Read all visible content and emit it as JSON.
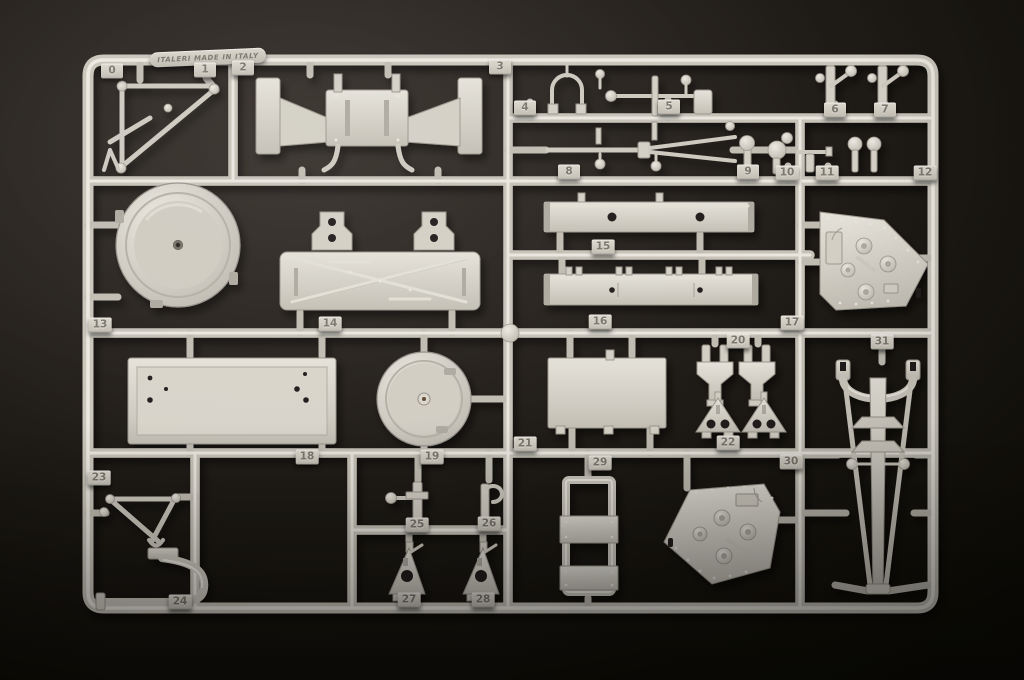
{
  "brand_plaque": {
    "text": "ITALERI MADE IN ITALY"
  },
  "colors": {
    "plastic": "#d5d1c7",
    "plastic_highlight": "#eae7df",
    "plastic_shadow": "#9c978d",
    "background": "#16120f",
    "tab_text": "#7b766c"
  },
  "sprue": {
    "part_count": 32,
    "parts": [
      {
        "label": "0",
        "x": 112,
        "y": 71
      },
      {
        "label": "1",
        "x": 205,
        "y": 70
      },
      {
        "label": "2",
        "x": 243,
        "y": 68
      },
      {
        "label": "3",
        "x": 500,
        "y": 67
      },
      {
        "label": "4",
        "x": 525,
        "y": 108
      },
      {
        "label": "5",
        "x": 669,
        "y": 107
      },
      {
        "label": "6",
        "x": 835,
        "y": 110
      },
      {
        "label": "7",
        "x": 885,
        "y": 110
      },
      {
        "label": "8",
        "x": 569,
        "y": 172
      },
      {
        "label": "9",
        "x": 748,
        "y": 172
      },
      {
        "label": "10",
        "x": 787,
        "y": 173
      },
      {
        "label": "11",
        "x": 827,
        "y": 173
      },
      {
        "label": "12",
        "x": 925,
        "y": 173
      },
      {
        "label": "13",
        "x": 100,
        "y": 325
      },
      {
        "label": "14",
        "x": 330,
        "y": 324
      },
      {
        "label": "15",
        "x": 603,
        "y": 247
      },
      {
        "label": "16",
        "x": 600,
        "y": 322
      },
      {
        "label": "17",
        "x": 792,
        "y": 323
      },
      {
        "label": "18",
        "x": 307,
        "y": 457
      },
      {
        "label": "19",
        "x": 432,
        "y": 457
      },
      {
        "label": "20",
        "x": 738,
        "y": 341
      },
      {
        "label": "21",
        "x": 525,
        "y": 444
      },
      {
        "label": "22",
        "x": 728,
        "y": 443
      },
      {
        "label": "23",
        "x": 99,
        "y": 478
      },
      {
        "label": "24",
        "x": 180,
        "y": 602
      },
      {
        "label": "25",
        "x": 417,
        "y": 525
      },
      {
        "label": "26",
        "x": 489,
        "y": 524
      },
      {
        "label": "27",
        "x": 409,
        "y": 600
      },
      {
        "label": "28",
        "x": 483,
        "y": 600
      },
      {
        "label": "29",
        "x": 600,
        "y": 463
      },
      {
        "label": "30",
        "x": 791,
        "y": 462
      },
      {
        "label": "31",
        "x": 882,
        "y": 342
      }
    ]
  }
}
